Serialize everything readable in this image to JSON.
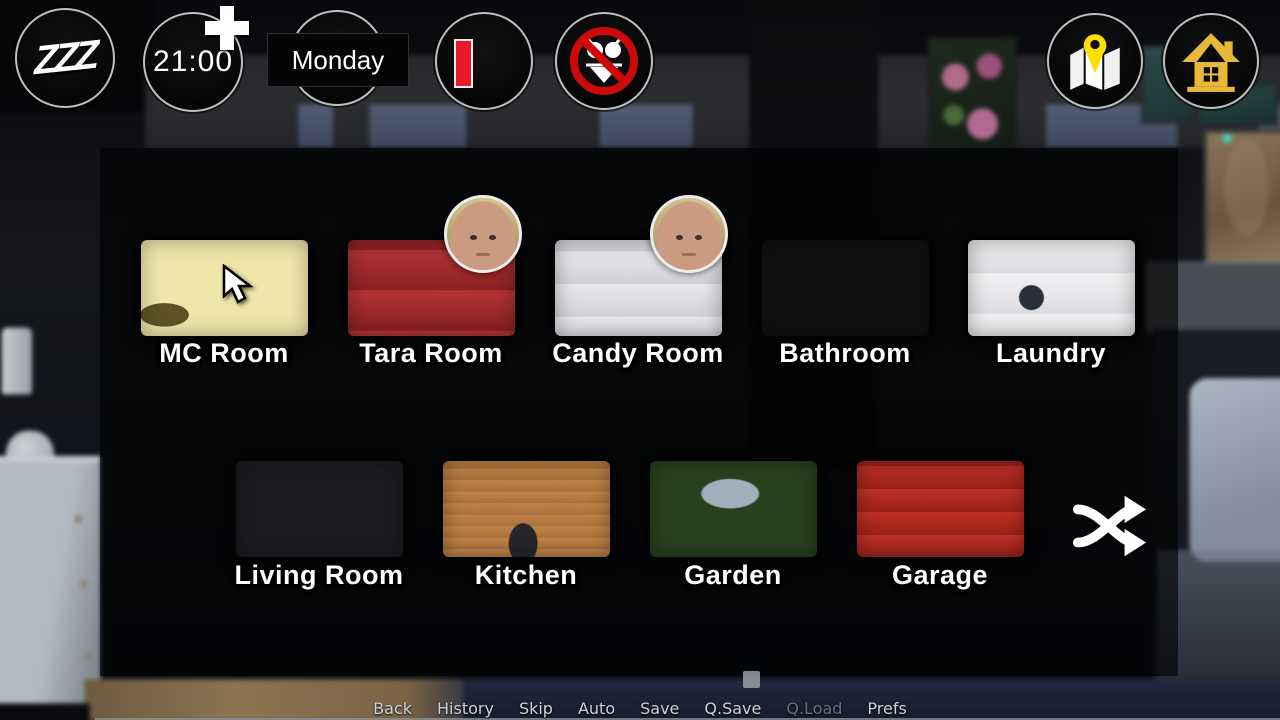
{
  "hud": {
    "sleep": {
      "icon_label": "ZZZ"
    },
    "time": {
      "value": "21:00"
    },
    "day": {
      "value": "Monday"
    },
    "energy": {
      "level": "low"
    },
    "no_bikini": {
      "state": "forbidden"
    }
  },
  "rooms": {
    "row1": [
      {
        "id": "mc-room",
        "name": "MC Room",
        "highlighted": true,
        "cursor_over": true
      },
      {
        "id": "tara-room",
        "name": "Tara Room",
        "occupant": "Tara"
      },
      {
        "id": "candy-room",
        "name": "Candy Room",
        "occupant": "Candy"
      },
      {
        "id": "bathroom",
        "name": "Bathroom"
      },
      {
        "id": "laundry",
        "name": "Laundry"
      }
    ],
    "row2": [
      {
        "id": "living-room",
        "name": "Living Room"
      },
      {
        "id": "kitchen",
        "name": "Kitchen"
      },
      {
        "id": "garden",
        "name": "Garden"
      },
      {
        "id": "garage",
        "name": "Garage"
      }
    ]
  },
  "quick_menu": {
    "items": [
      {
        "label": "Back",
        "enabled": true
      },
      {
        "label": "History",
        "enabled": true
      },
      {
        "label": "Skip",
        "enabled": true
      },
      {
        "label": "Auto",
        "enabled": true
      },
      {
        "label": "Save",
        "enabled": true
      },
      {
        "label": "Q.Save",
        "enabled": true
      },
      {
        "label": "Q.Load",
        "enabled": false
      },
      {
        "label": "Prefs",
        "enabled": true
      }
    ]
  },
  "colors": {
    "highlight_yellow": "#d2c170",
    "hud_gold": "#e8b839",
    "pin_yellow": "#ffe000",
    "prohibition_red": "#cc0a0a",
    "energy_red": "#e8192c",
    "menu_disabled": "#666e80"
  }
}
